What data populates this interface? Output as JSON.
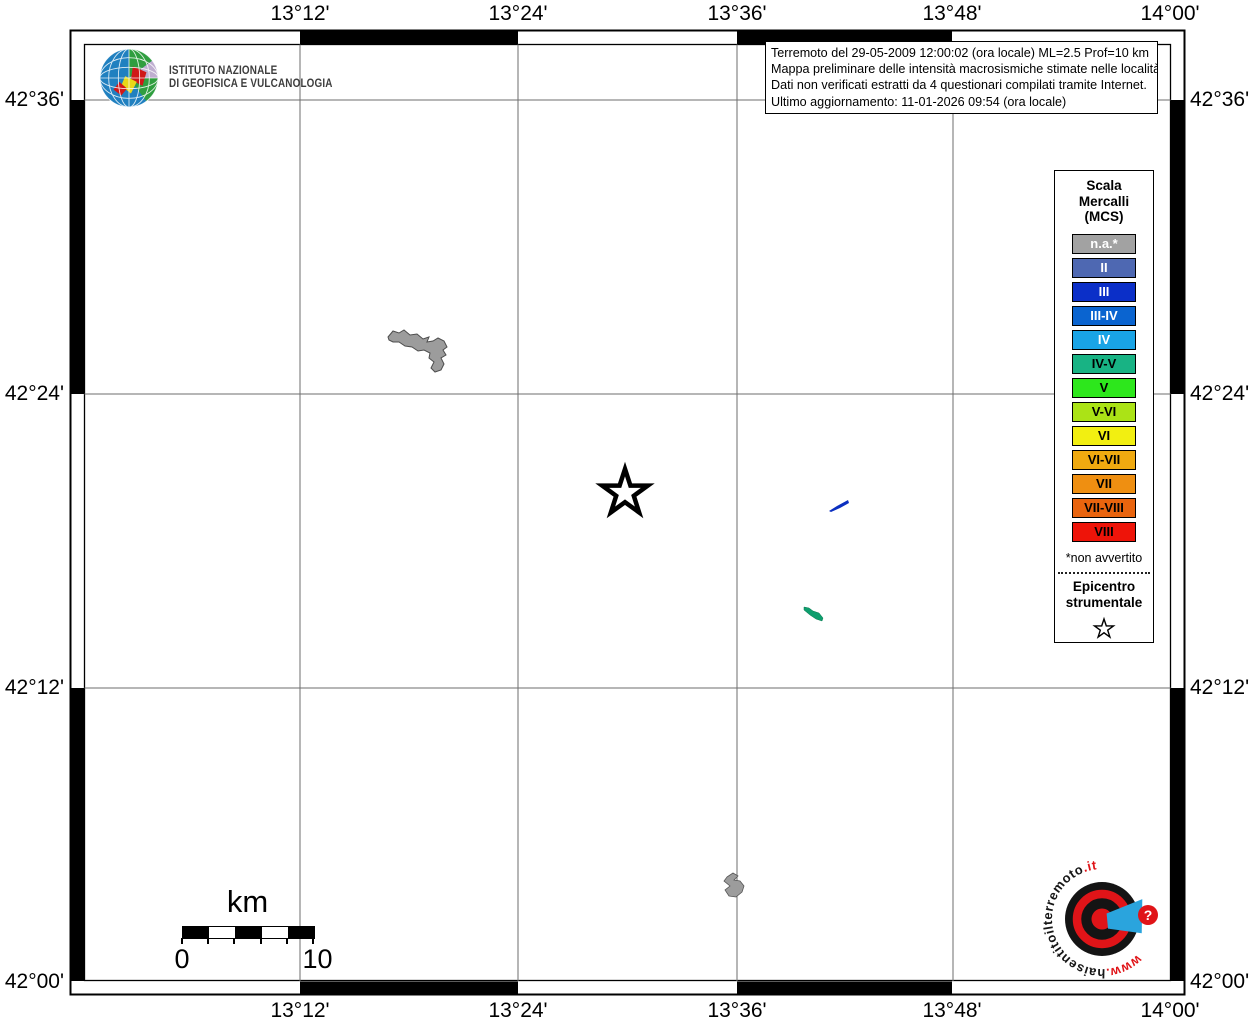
{
  "axis": {
    "top": [
      "13°12'",
      "13°24'",
      "13°36'",
      "13°48'",
      "14°00'"
    ],
    "bottom": [
      "13°12'",
      "13°24'",
      "13°36'",
      "13°48'",
      "14°00'"
    ],
    "left": [
      "42°36'",
      "42°24'",
      "42°12'",
      "42°00'"
    ],
    "right": [
      "42°36'",
      "42°24'",
      "42°12'",
      "42°00'"
    ]
  },
  "ingv_logo": {
    "line1": "ISTITUTO NAZIONALE",
    "line2": "DI GEOFISICA E VULCANOLOGIA"
  },
  "info_box": {
    "line1": "Terremoto del 29-05-2009 12:00:02 (ora locale) ML=2.5 Prof=10 km",
    "line2": "Mappa preliminare delle intensità macrosismiche stimate nelle località",
    "line3": "Dati non verificati estratti da 4 questionari compilati tramite Internet.",
    "line4": "Ultimo aggiornamento: 11-01-2026 09:54 (ora locale)"
  },
  "legend": {
    "title1": "Scala",
    "title2": "Mercalli",
    "title3": "(MCS)",
    "items": [
      {
        "label": "n.a.*",
        "color": "#a2a2a2",
        "text_color": "#ffffff"
      },
      {
        "label": "II",
        "color": "#4e68b2",
        "text_color": "#ffffff"
      },
      {
        "label": "III",
        "color": "#0b2fc8",
        "text_color": "#ffffff"
      },
      {
        "label": "III-IV",
        "color": "#0a64d0",
        "text_color": "#ffffff"
      },
      {
        "label": "IV",
        "color": "#19a4e6",
        "text_color": "#ffffff"
      },
      {
        "label": "IV-V",
        "color": "#18b384",
        "text_color": "#000000"
      },
      {
        "label": "V",
        "color": "#2de71c",
        "text_color": "#000000"
      },
      {
        "label": "V-VI",
        "color": "#abe316",
        "text_color": "#000000"
      },
      {
        "label": "VI",
        "color": "#f2ef11",
        "text_color": "#000000"
      },
      {
        "label": "VI-VII",
        "color": "#f0aa10",
        "text_color": "#000000"
      },
      {
        "label": "VII",
        "color": "#ef8f11",
        "text_color": "#000000"
      },
      {
        "label": "VII-VIII",
        "color": "#e9640e",
        "text_color": "#000000"
      },
      {
        "label": "VIII",
        "color": "#ee1409",
        "text_color": "#000000"
      }
    ],
    "footnote": "*non avvertito",
    "epicenter1": "Epicentro",
    "epicenter2": "strumentale"
  },
  "scale_bar": {
    "unit": "km",
    "label_start": "0",
    "label_end": "10"
  },
  "watermark": {
    "www": "www.",
    "main": "haisentitoilterremoto",
    "tld": ".it",
    "question": "?"
  }
}
